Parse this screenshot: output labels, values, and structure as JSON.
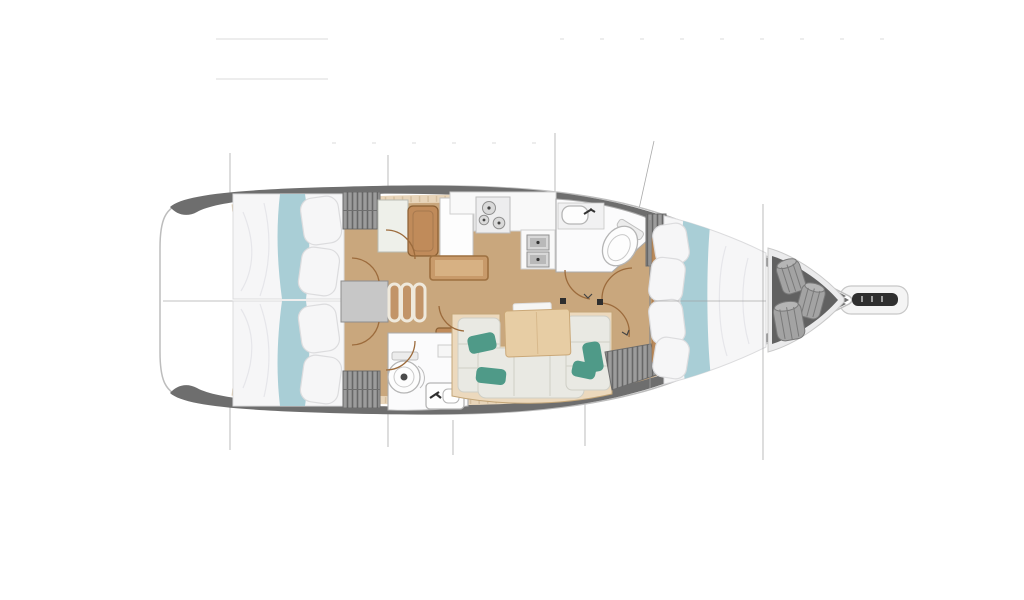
{
  "plan": {
    "type": "sailboat-deck-plan-top-view",
    "orientation": "bow-right",
    "areas": [
      {
        "id": "aft-cabin-port",
        "kind": "double-berth-cabin"
      },
      {
        "id": "aft-cabin-starboard",
        "kind": "double-berth-cabin"
      },
      {
        "id": "companionway-steps",
        "kind": "stairs"
      },
      {
        "id": "nav-area",
        "kind": "seat-and-lockers"
      },
      {
        "id": "galley",
        "kind": "stove-and-double-sink"
      },
      {
        "id": "forward-head",
        "kind": "toilet-and-sink"
      },
      {
        "id": "aft-head",
        "kind": "toilet-and-sink"
      },
      {
        "id": "salon-settee",
        "kind": "u-shaped-sofa-with-table"
      },
      {
        "id": "forward-cabin",
        "kind": "v-berth-cabin"
      },
      {
        "id": "sail-locker",
        "kind": "storage-with-fenders"
      },
      {
        "id": "bowsprit",
        "kind": "anchor-roller-platform"
      }
    ]
  },
  "colors": {
    "background": "#ffffff",
    "hull_line": "#bdbdbd",
    "deck_band": "#6e6e6e",
    "deck_trim": "#e8d5ba",
    "trim_tick": "#c4ad89",
    "floor_wood": "#c9a77d",
    "wood_dark": "#8a5f33",
    "wood_mid": "#c08b5a",
    "wood_light": "#c89a6a",
    "bed_white": "#f6f6f7",
    "bed_line": "#dcdcde",
    "teal_fabric": "#a9ced6",
    "teal_pillow": "#4f9a88",
    "cushion": "#e9e9e3",
    "settee_base": "#ecd9bd",
    "table_wood": "#e7cda4",
    "counter_white": "#f9f9f9",
    "fixture_line": "#ababab",
    "steel": "#d8d8d8",
    "wardrobe_gray": "#9c9c9c",
    "hatch_dark": "#5e5e5e",
    "locker_dark": "#616161",
    "bag_gray": "#a3a3a3",
    "step_tread": "#c29468",
    "landing_gray": "#c7c7c7",
    "door_arc": "#9c6b3c",
    "section_line": "#9b9b9b",
    "faint_line": "#ededed",
    "roller_dark": "#2f2f2f"
  }
}
